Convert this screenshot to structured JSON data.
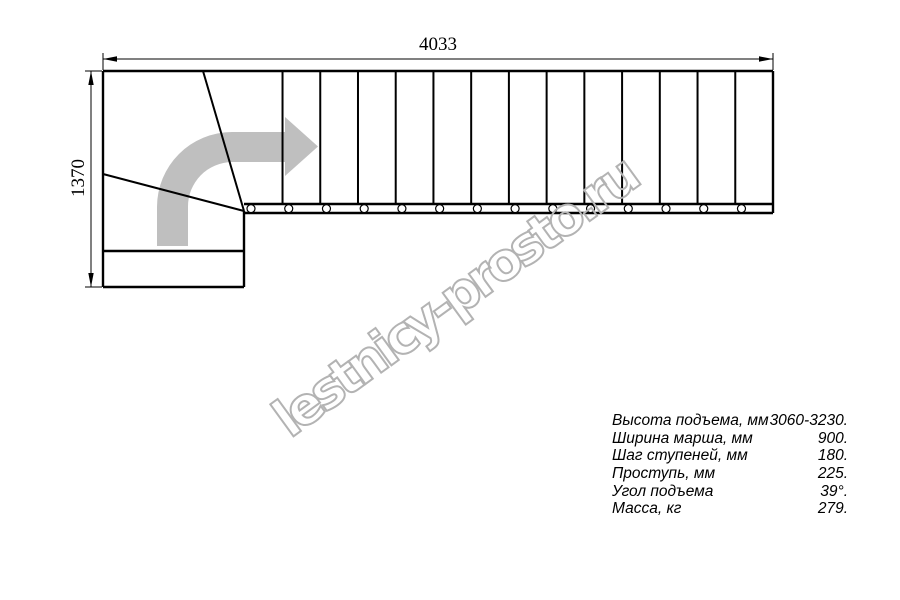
{
  "drawing": {
    "width_dim": "4033",
    "height_dim": "1370",
    "tread_line_count": 13,
    "circle_count": 14
  },
  "watermark": {
    "text": "lestnicy-prosto.ru"
  },
  "specs": {
    "rows": [
      {
        "label": "Высота подъема, мм",
        "value": "3060-3230."
      },
      {
        "label": "Ширина марша, мм",
        "value": "900."
      },
      {
        "label": "Шаг ступеней, мм",
        "value": "180."
      },
      {
        "label": "Проступь, мм",
        "value": "225."
      },
      {
        "label": "Угол подъема",
        "value": "39°."
      },
      {
        "label": "Масса, кг",
        "value": "279."
      }
    ]
  },
  "colors": {
    "line": "#000000",
    "arrow": "#bfbfbf",
    "watermark": "#b3b3b3"
  }
}
